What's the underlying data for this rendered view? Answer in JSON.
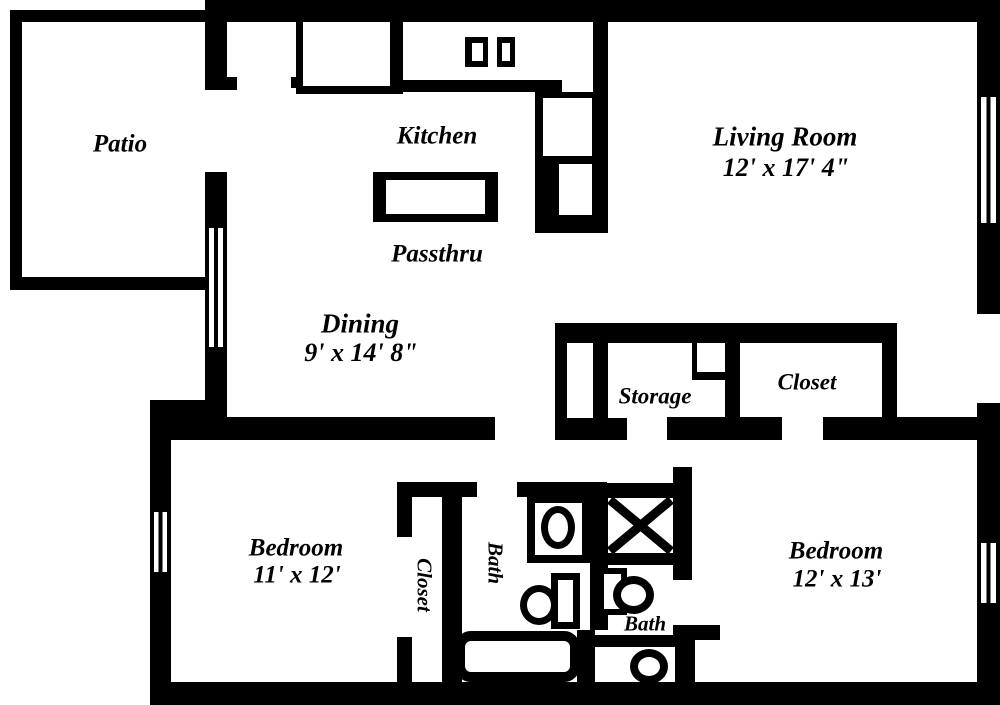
{
  "document": {
    "type": "apartment-floor-plan"
  },
  "colors": {
    "wall": "#000000",
    "floor": "#ffffff",
    "text": "#000000"
  },
  "rooms": {
    "patio": {
      "label": "Patio"
    },
    "kitchen": {
      "label": "Kitchen"
    },
    "passthru": {
      "label": "Passthru"
    },
    "living_room": {
      "label": "Living Room",
      "dimensions": "12' x 17' 4\""
    },
    "dining": {
      "label": "Dining",
      "dimensions": "9' x 14' 8\""
    },
    "storage": {
      "label": "Storage"
    },
    "hall_closet": {
      "label": "Closet"
    },
    "bedroom_left": {
      "label": "Bedroom",
      "dimensions": "11' x 12'"
    },
    "bedroom_left_closet": {
      "label": "Closet"
    },
    "bath_main": {
      "label": "Bath"
    },
    "bath_second": {
      "label": "Bath"
    },
    "bedroom_right": {
      "label": "Bedroom",
      "dimensions": "12' x 13'"
    }
  },
  "fixtures": {
    "kitchen_sink": "double-basin-sink",
    "refrigerator": "refrigerator",
    "kitchen_counter": "counter",
    "passthru_counter": "passthru-island",
    "shower": "shower-stall",
    "bathtub": "bathtub",
    "toilet": "toilet",
    "oval_sink": "oval-sink",
    "window": "window-triple-line"
  }
}
